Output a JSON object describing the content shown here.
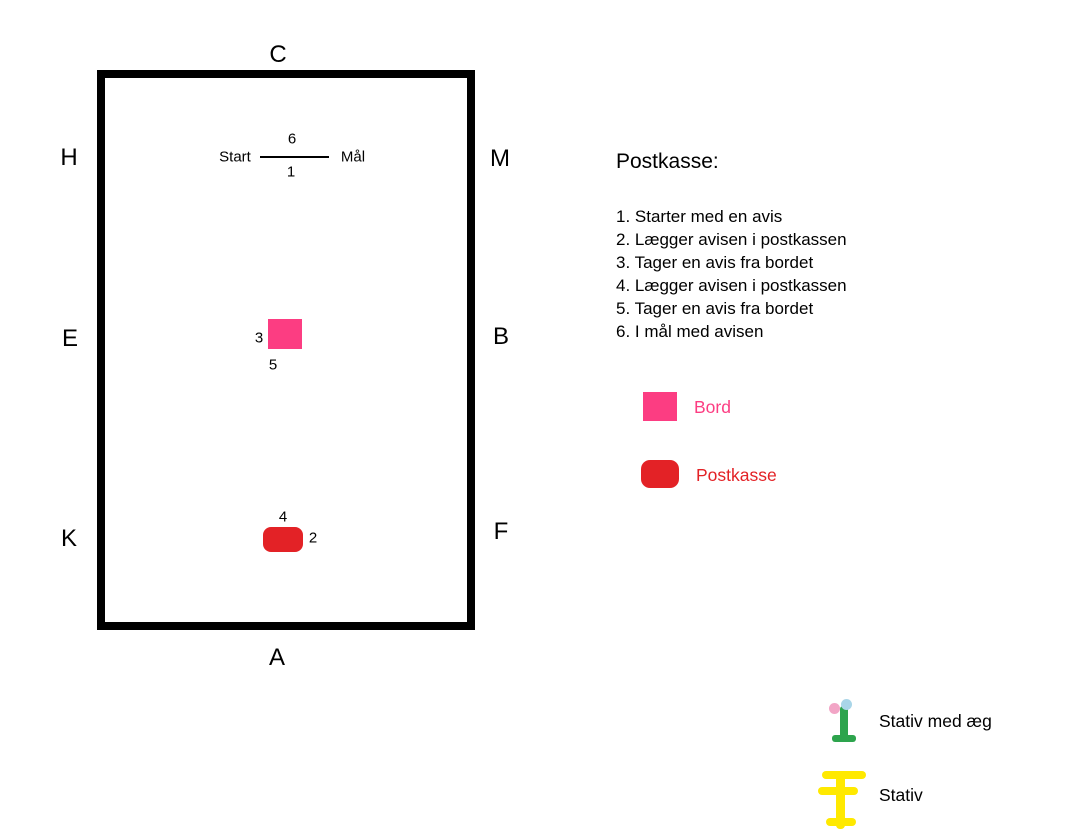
{
  "diagram": {
    "arena": {
      "letters": {
        "top": "C",
        "bottom": "A",
        "left_top": "H",
        "left_middle": "E",
        "left_bottom": "K",
        "right_top": "M",
        "right_middle": "B",
        "right_bottom": "F"
      },
      "start_label": "Start",
      "goal_label": "Mål",
      "line_numbers": {
        "above": "6",
        "below": "1"
      },
      "bord_numbers": {
        "left": "3",
        "below": "5"
      },
      "postkasse_numbers": {
        "above": "4",
        "right": "2"
      }
    },
    "info": {
      "title": "Postkasse:",
      "steps": [
        "1. Starter med en avis",
        "2. Lægger avisen i postkassen",
        "3. Tager en avis fra bordet",
        "4. Lægger avisen i postkassen",
        "5. Tager en avis fra bordet",
        "6. I mål med avisen"
      ]
    },
    "legend": {
      "bord_label": "Bord",
      "postkasse_label": "Postkasse"
    },
    "stands": {
      "with_egg_label": "Stativ med æg",
      "plain_label": "Stativ"
    },
    "colors": {
      "bord_pink": "#FC3D82",
      "postkasse_red": "#E32226",
      "stand_green": "#2DA44D",
      "egg_pink": "#F2A5C6",
      "egg_blue": "#A9D5E8",
      "stand_yellow": "#FFE900"
    }
  }
}
